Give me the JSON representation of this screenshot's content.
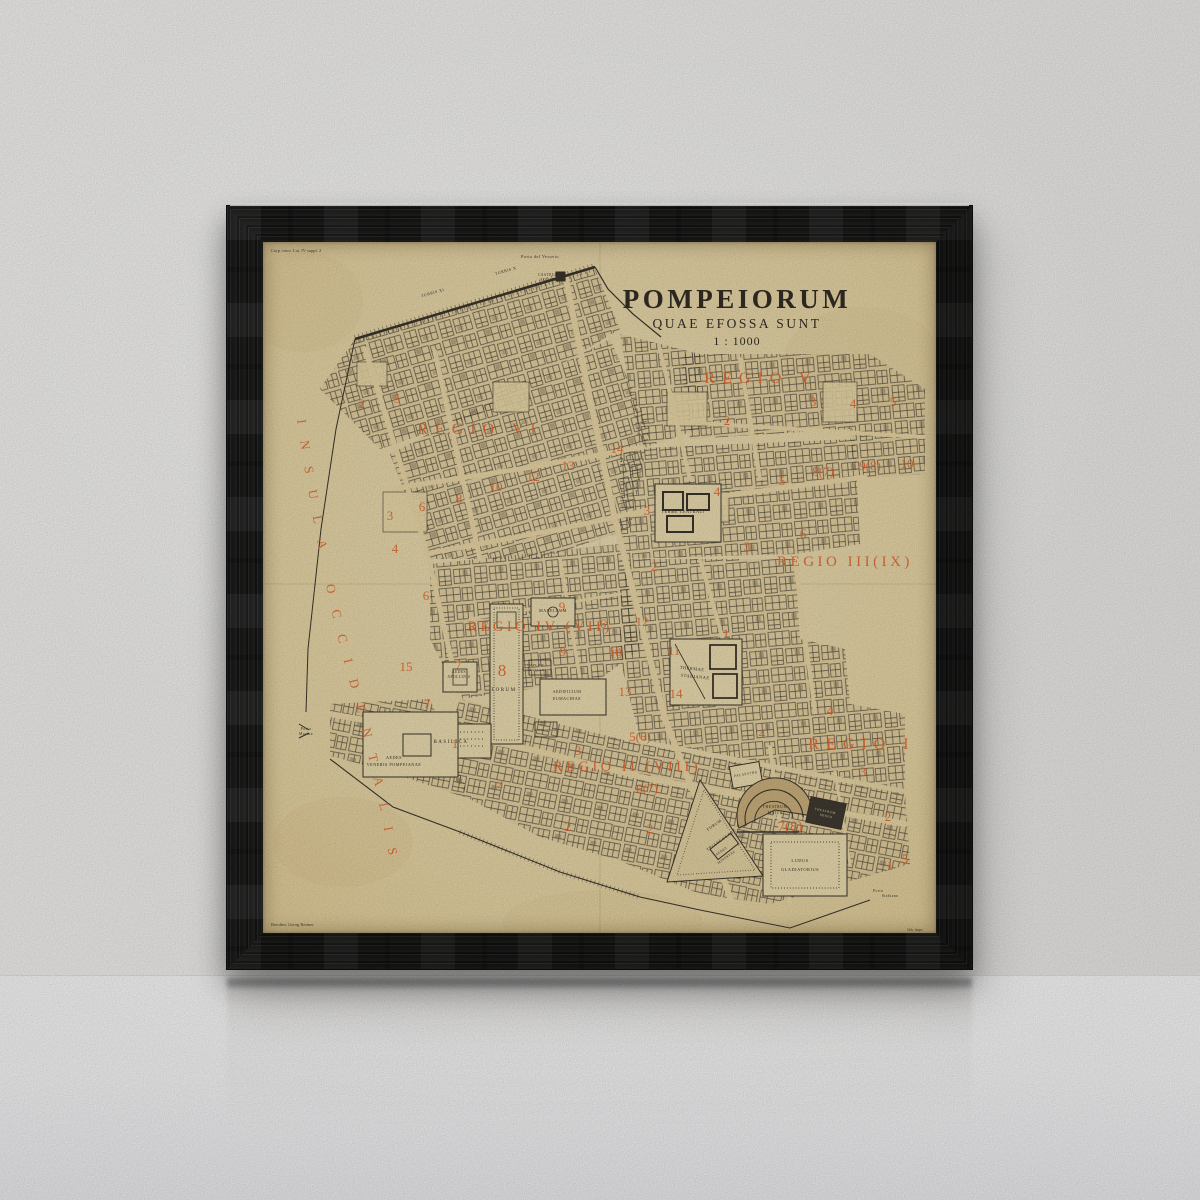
{
  "map": {
    "title": "POMPEIORUM",
    "subtitle": "QUAE EFOSSA SUNT",
    "scale": "1 : 1000",
    "corner_note": "Corp. inscr. Lat. IV suppl. 2",
    "imprint_left": "Berolini: Georg Reimer",
    "imprint_right": "lith. impr.",
    "insula_label": "INSULA OCCIDENTALIS",
    "colors": {
      "accent": "#e8682f",
      "ink": "#3b352b",
      "paper": "#eedcab"
    },
    "regions": [
      {
        "t": "REGIO V",
        "x": 498,
        "y": 141,
        "s": 16,
        "ls": 7
      },
      {
        "t": "REGIO VI",
        "x": 217,
        "y": 192,
        "s": 16,
        "ls": 7
      },
      {
        "t": "REGIO III(IX)",
        "x": 582,
        "y": 324,
        "s": 15,
        "ls": 3.5
      },
      {
        "t": "REGIO IV (VII)",
        "x": 277,
        "y": 389,
        "s": 14.5,
        "ls": 3.5
      },
      {
        "t": "REGIO II (VIII)",
        "x": 364,
        "y": 529,
        "s": 14.5,
        "ls": 3.5
      },
      {
        "t": "REGIO I",
        "x": 599,
        "y": 507,
        "s": 16,
        "ls": 7
      }
    ],
    "numbers": [
      {
        "t": "2",
        "x": 99,
        "y": 166
      },
      {
        "t": "5",
        "x": 134,
        "y": 161
      },
      {
        "t": "6",
        "x": 159,
        "y": 269
      },
      {
        "t": "8",
        "x": 196,
        "y": 261
      },
      {
        "t": "10",
        "x": 233,
        "y": 249
      },
      {
        "t": "12",
        "x": 270,
        "y": 239
      },
      {
        "t": "13",
        "x": 305,
        "y": 228
      },
      {
        "t": "14",
        "x": 354,
        "y": 211
      },
      {
        "t": "3",
        "x": 127,
        "y": 278
      },
      {
        "t": "4",
        "x": 132,
        "y": 311
      },
      {
        "t": "6",
        "x": 163,
        "y": 358
      },
      {
        "t": "15",
        "x": 143,
        "y": 429
      },
      {
        "t": "7",
        "x": 164,
        "y": 466
      },
      {
        "t": "2",
        "x": 464,
        "y": 183
      },
      {
        "t": "3",
        "x": 550,
        "y": 164
      },
      {
        "t": "4",
        "x": 590,
        "y": 166
      },
      {
        "t": "5",
        "x": 630,
        "y": 164
      },
      {
        "t": "8(7)",
        "x": 560,
        "y": 234
      },
      {
        "t": "9(8)",
        "x": 607,
        "y": 228
      },
      {
        "t": "10",
        "x": 644,
        "y": 226
      },
      {
        "t": "4",
        "x": 454,
        "y": 254
      },
      {
        "t": "5",
        "x": 519,
        "y": 243
      },
      {
        "t": "3",
        "x": 484,
        "y": 309
      },
      {
        "t": "6",
        "x": 540,
        "y": 296
      },
      {
        "t": "2",
        "x": 391,
        "y": 329
      },
      {
        "t": "3",
        "x": 384,
        "y": 273
      },
      {
        "t": "6",
        "x": 340,
        "y": 386
      },
      {
        "t": "12",
        "x": 379,
        "y": 384
      },
      {
        "t": "10",
        "x": 353,
        "y": 416
      },
      {
        "t": "11",
        "x": 411,
        "y": 413
      },
      {
        "t": "13",
        "x": 362,
        "y": 454
      },
      {
        "t": "14",
        "x": 413,
        "y": 456
      },
      {
        "t": "1",
        "x": 463,
        "y": 396
      },
      {
        "t": "4",
        "x": 499,
        "y": 496
      },
      {
        "t": "5(6)",
        "x": 377,
        "y": 499
      },
      {
        "t": "7",
        "x": 195,
        "y": 428
      },
      {
        "t": "8",
        "x": 239,
        "y": 434,
        "s": 17
      },
      {
        "t": "9",
        "x": 299,
        "y": 369
      },
      {
        "t": "9",
        "x": 300,
        "y": 414
      },
      {
        "t": "10",
        "x": 352,
        "y": 414
      },
      {
        "t": "1",
        "x": 192,
        "y": 506
      },
      {
        "t": "3",
        "x": 315,
        "y": 513
      },
      {
        "t": "2",
        "x": 237,
        "y": 546
      },
      {
        "t": "6(7)",
        "x": 384,
        "y": 551
      },
      {
        "t": "2",
        "x": 305,
        "y": 589
      },
      {
        "t": "2",
        "x": 387,
        "y": 591
      },
      {
        "t": "7(8)",
        "x": 527,
        "y": 589,
        "s": 15
      },
      {
        "t": "2",
        "x": 625,
        "y": 579
      },
      {
        "t": "3",
        "x": 600,
        "y": 534
      },
      {
        "t": "1",
        "x": 627,
        "y": 628
      },
      {
        "t": "4",
        "x": 567,
        "y": 473
      },
      {
        "t": "5",
        "x": 642,
        "y": 621
      }
    ],
    "buildings": [
      {
        "t": "Porta del Vesuvio",
        "x": 277,
        "y": 16,
        "s": 4.2
      },
      {
        "t": "TURRIS X",
        "x": 243,
        "y": 30,
        "s": 4,
        "r": -16
      },
      {
        "t": "TURRIS XI",
        "x": 170,
        "y": 52,
        "s": 4,
        "r": -16
      },
      {
        "t": "CASTELLUM",
        "x": 288,
        "y": 34,
        "s": 3.6
      },
      {
        "t": "AQUARUM",
        "x": 288,
        "y": 39,
        "s": 3.6
      },
      {
        "t": "TERME CENTRALI",
        "x": 420,
        "y": 271,
        "s": 4.2
      },
      {
        "t": "THERMAE",
        "x": 429,
        "y": 428,
        "s": 4.4,
        "r": 6
      },
      {
        "t": "STABIANAE",
        "x": 432,
        "y": 436,
        "s": 4.4,
        "r": 6
      },
      {
        "t": "MACELLUM",
        "x": 290,
        "y": 370,
        "s": 4.2
      },
      {
        "t": "FORUM",
        "x": 241,
        "y": 449,
        "s": 5,
        "ls": 1.5
      },
      {
        "t": "BASILICA",
        "x": 188,
        "y": 501,
        "s": 5,
        "ls": 1.5
      },
      {
        "t": "AEDES",
        "x": 131,
        "y": 517,
        "s": 4.2
      },
      {
        "t": "VENERIS POMPEIANAE",
        "x": 131,
        "y": 524,
        "s": 4.2
      },
      {
        "t": "AEDES",
        "x": 196,
        "y": 431,
        "s": 3.6
      },
      {
        "t": "APOLLINIS",
        "x": 196,
        "y": 436,
        "s": 3.6
      },
      {
        "t": "Porta",
        "x": 43,
        "y": 488,
        "s": 3.8
      },
      {
        "t": "Marina",
        "x": 43,
        "y": 493,
        "s": 3.8
      },
      {
        "t": "AEDIFICIUM",
        "x": 304,
        "y": 451,
        "s": 4
      },
      {
        "t": "EUMACHIAE",
        "x": 304,
        "y": 458,
        "s": 4
      },
      {
        "t": "TEMPLUM",
        "x": 271,
        "y": 424,
        "s": 3.4
      },
      {
        "t": "VESPASIANI",
        "x": 271,
        "y": 429,
        "s": 3.4
      },
      {
        "t": "COMITIUM",
        "x": 283,
        "y": 489,
        "s": 3.4
      },
      {
        "t": "FORUM",
        "x": 452,
        "y": 584,
        "s": 4.2,
        "r": -35
      },
      {
        "t": "TRIANGULARE",
        "x": 459,
        "y": 599,
        "s": 4.2,
        "r": -35
      },
      {
        "t": "AEDES",
        "x": 459,
        "y": 610,
        "s": 3.4,
        "r": -35
      },
      {
        "t": "MINERVAE",
        "x": 464,
        "y": 616,
        "s": 3.4,
        "r": -35
      },
      {
        "t": "THEATRUM",
        "x": 512,
        "y": 566,
        "s": 3.8
      },
      {
        "t": "MAIUS",
        "x": 512,
        "y": 572,
        "s": 3.8
      },
      {
        "t": "THEATRUM",
        "x": 562,
        "y": 570,
        "s": 3.2,
        "r": 12,
        "f": "#e9dcb2"
      },
      {
        "t": "MINUS",
        "x": 563,
        "y": 575,
        "s": 3.2,
        "r": 12,
        "f": "#e9dcb2"
      },
      {
        "t": "LUDUS",
        "x": 537,
        "y": 620,
        "s": 4.4
      },
      {
        "t": "GLADIATORIUS",
        "x": 537,
        "y": 629,
        "s": 4.4
      },
      {
        "t": "PALAESTRA",
        "x": 483,
        "y": 533,
        "s": 3.4,
        "r": -10
      },
      {
        "t": "Porta",
        "x": 615,
        "y": 650,
        "s": 3.6
      },
      {
        "t": "Stabiana",
        "x": 627,
        "y": 655,
        "s": 3.6
      }
    ]
  }
}
